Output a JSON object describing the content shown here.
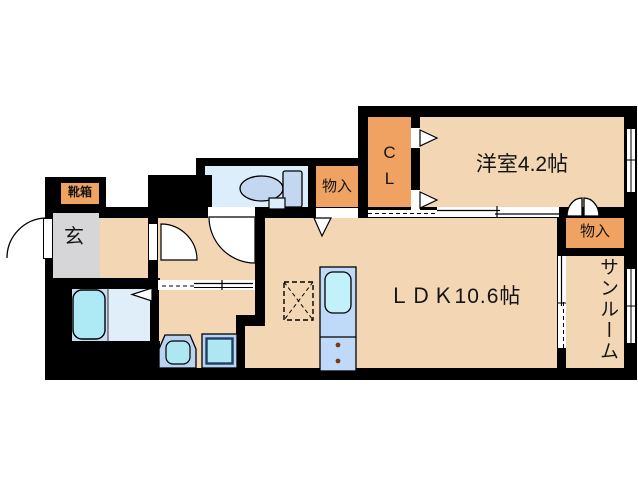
{
  "plan": {
    "title": "apartment floor plan",
    "rooms": {
      "western_room": {
        "label": "洋室4.2帖"
      },
      "ldk": {
        "label": "ＬＤＫ10.6帖"
      },
      "sunroom": {
        "label": "サンルーム"
      },
      "closet": {
        "label": "C\nL"
      },
      "storage_top": {
        "label": "物入"
      },
      "storage_right": {
        "label": "物入"
      },
      "entrance": {
        "label": "玄"
      },
      "shoe_box": {
        "label": "靴箱"
      }
    },
    "colors": {
      "floor": "#f3d6b4",
      "storage_orange": "#f0a262",
      "wall_black": "#000000",
      "toilet_room_blue": "#dceefb",
      "entrance_gray": "#d6d6d9",
      "bath_blue": "#c8ddf2",
      "shower_blue": "#e0eefa",
      "tub_cyan": "#aeeaf5",
      "fixture_blue": "#c3d8f0",
      "kitchen_blue": "#bfd9f8",
      "kitchen_sink_cyan": "#c2f1fa",
      "vanity_blue": "#b9d3f2",
      "pan_cyan": "#aee6f2"
    }
  }
}
